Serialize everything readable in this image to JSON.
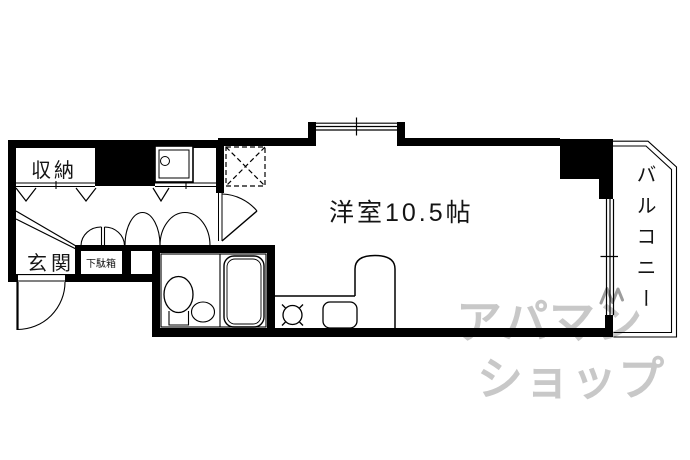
{
  "plan": {
    "storage_label": "収納",
    "entrance_label": "玄関",
    "shoe_cabinet_label": "下駄箱",
    "main_room_label": "洋室10.5帖",
    "balcony_label": "バルコニー"
  },
  "watermark": {
    "line1": "アパマン",
    "line2": "ショップ"
  },
  "colors": {
    "line": "#000000",
    "background": "#ffffff",
    "watermark_gray": "#c8c8c8"
  }
}
